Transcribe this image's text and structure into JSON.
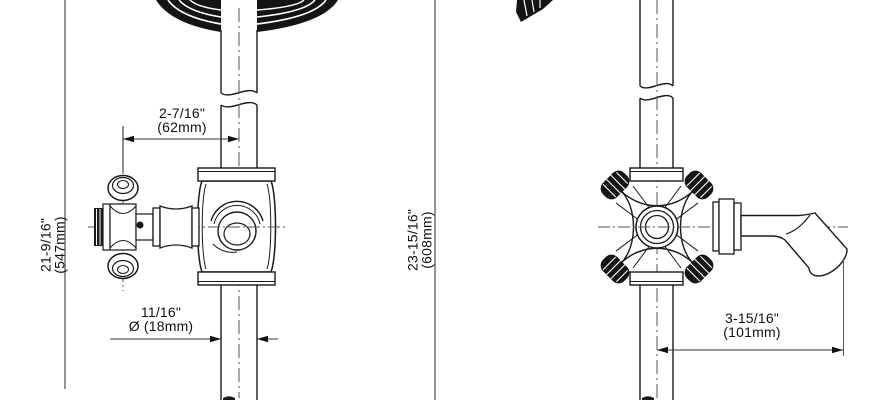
{
  "drawing": {
    "left_view": {
      "spacing_dim": {
        "imperial": "2-7/16\"",
        "metric": "(62mm)"
      },
      "height_dim": {
        "imperial": "21-9/16\"",
        "metric": "(547mm)"
      },
      "diameter_dim": {
        "imperial": "11/16\"",
        "metric": "Ø (18mm)"
      }
    },
    "right_view": {
      "height_dim": {
        "imperial": "23-15/16\"",
        "metric": "(608mm)"
      },
      "spout_dim": {
        "imperial": "3-15/16\"",
        "metric": "(101mm)"
      }
    },
    "colors": {
      "line": "#1a1a1a",
      "thin_line": "#555555",
      "dim_line": "#7a7a7a",
      "text": "#111111"
    }
  }
}
